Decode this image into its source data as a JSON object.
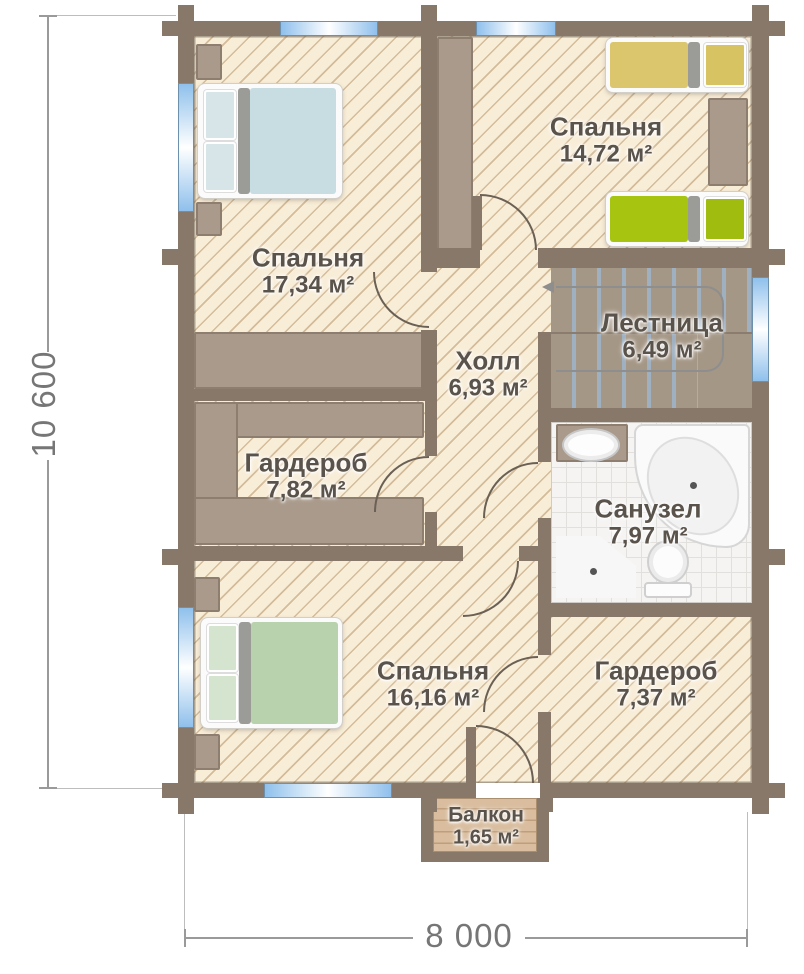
{
  "plan": {
    "rooms": [
      {
        "id": "bedroom-top-left",
        "name": "Спальня",
        "area": "17,34 м²"
      },
      {
        "id": "bedroom-top-right",
        "name": "Спальня",
        "area": "14,72 м²"
      },
      {
        "id": "staircase",
        "name": "Лестница",
        "area": "6,49 м²"
      },
      {
        "id": "hall",
        "name": "Холл",
        "area": "6,93 м²"
      },
      {
        "id": "wardrobe-left",
        "name": "Гардероб",
        "area": "7,82 м²"
      },
      {
        "id": "bathroom",
        "name": "Санузел",
        "area": "7,97 м²"
      },
      {
        "id": "bedroom-bottom",
        "name": "Спальня",
        "area": "16,16 м²"
      },
      {
        "id": "wardrobe-right",
        "name": "Гардероб",
        "area": "7,37 м²"
      },
      {
        "id": "balcony",
        "name": "Балкон",
        "area": "1,65 м²"
      }
    ],
    "dimensions": {
      "vertical": "10 600",
      "horizontal": "8 000"
    },
    "colors": {
      "wall": "#87786a",
      "floor": "#f8edd7",
      "hatch_line": "#b08c5f",
      "window_blue": "#8fc0ec",
      "stairs": "#a59786",
      "furniture": "#a99a8b",
      "bed_blue": "#c7dde2",
      "bed_green": "#b8d2ad",
      "bed_yellow": "#dbc66d",
      "bed_lime": "#a7c411"
    }
  }
}
